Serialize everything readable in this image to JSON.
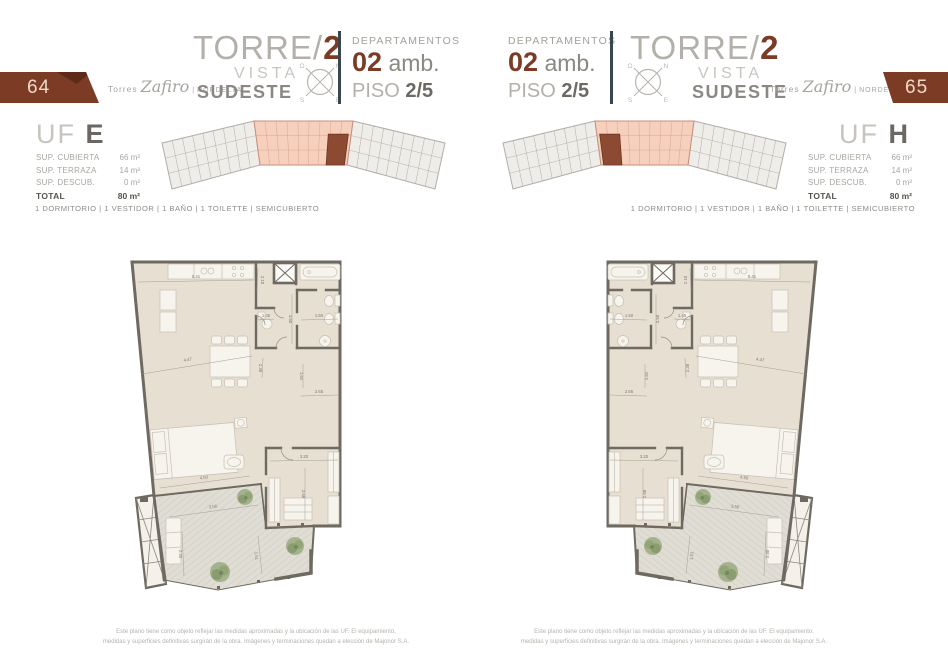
{
  "brand": {
    "torres": "Torres",
    "zafiro": "Zafiro",
    "separator": "|",
    "nordelta": "NORDELTA"
  },
  "header": {
    "torre_label": "TORRE/",
    "torre_number": "2",
    "vista_label": "VISTA",
    "direction": "SUDESTE",
    "departamentos_label": "DEPARTAMENTOS",
    "amb_number": "02",
    "amb_label": "amb.",
    "piso_label": "PISO",
    "piso_value": "2/5"
  },
  "compass": {
    "north": "N",
    "south": "S",
    "east": "E",
    "west": "O"
  },
  "pages": [
    {
      "page_number": "64",
      "unit_label": "UF",
      "unit_letter": "E"
    },
    {
      "page_number": "65",
      "unit_label": "UF",
      "unit_letter": "H"
    }
  ],
  "unit_table": {
    "rows": [
      {
        "label": "SUP. CUBIERTA",
        "value": "66 m²"
      },
      {
        "label": "SUP. TERRAZA",
        "value": "14 m²"
      },
      {
        "label": "SUP. DESCUB.",
        "value": "0 m²"
      }
    ],
    "total_label": "TOTAL",
    "total_value": "80 m²"
  },
  "features": "1 DORMITORIO | 1 VESTIDOR | 1 BAÑO | 1 TOILETTE | SEMICUBIERTO",
  "disclaimer": {
    "line1": "Este plano tiene como objeto reflejar las medidas aproximadas y la ubicación de las UF. El equipamiento,",
    "line2": "medidas y superficies definitivas surgirán de la obra. Imágenes y terminaciones quedan a elección de Majonor S.A."
  },
  "floorplan": {
    "dims": {
      "top_width": "5.41",
      "kitchen_depth": "2.10",
      "toilette_w": "1.45",
      "bath_w": "1.50",
      "bath_h": "3.50",
      "hall_h": "2.38",
      "living_diag": "4.47",
      "hall_w": "2.65",
      "closet_h": "1.61",
      "vestidor_w": "3.20",
      "vestidor_h": "2.68",
      "bed_width": "4.50",
      "terrace_w": "3.56",
      "terrace_h": "2.30",
      "terrace_r": "1.51"
    }
  },
  "colors": {
    "accent_brown": "#7c3b25",
    "badge_text": "#f2d9c8",
    "divider_slate": "#3a464e",
    "wall_gray": "#6e6a61",
    "floor_beige": "#e7dfd1",
    "terrace_floor": "#e0ddd5",
    "keyplan_gray": "#efede9",
    "keyplan_salmon": "#f6cfbd",
    "keyplan_unit_brown": "#8b4a31",
    "plant_green": "#96a87c"
  }
}
